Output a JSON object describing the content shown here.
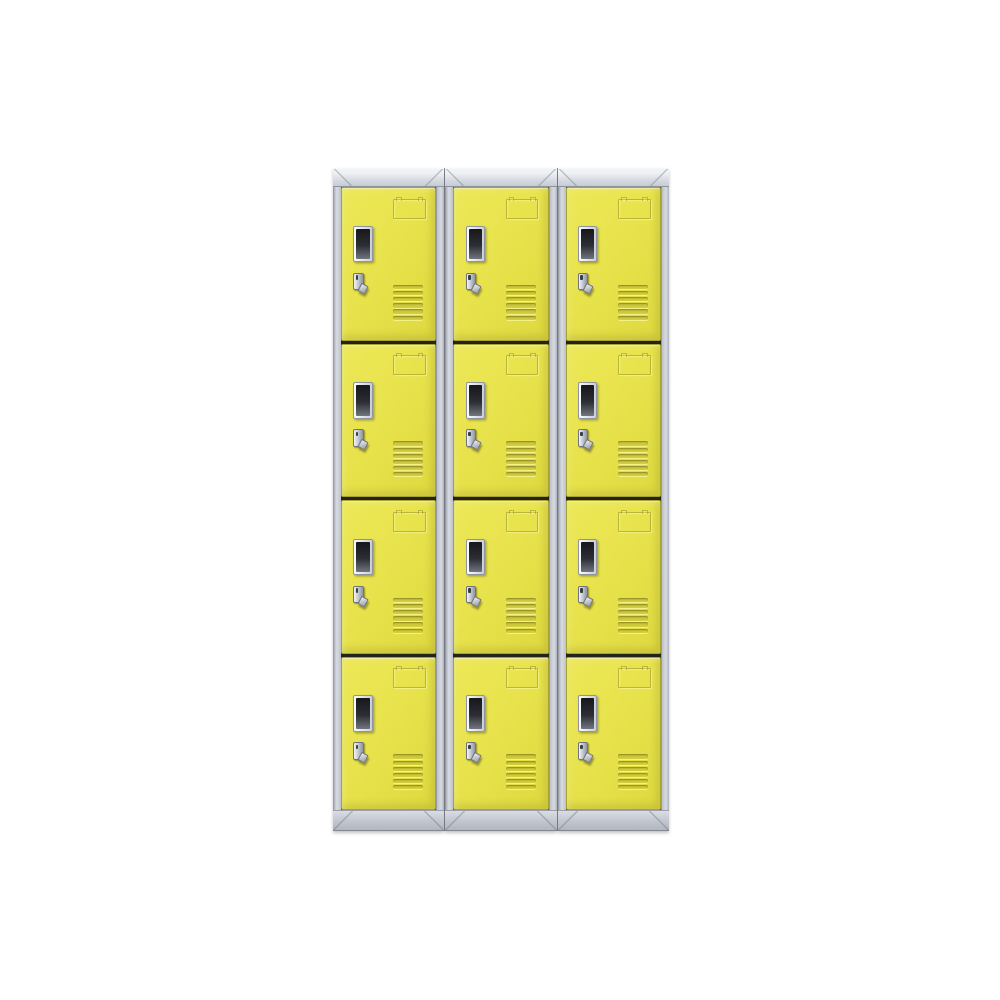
{
  "meta": {
    "type": "product-photo",
    "subject": "12-door storage locker cabinet set",
    "description": "Three side-by-side grey metal locker cabinets, each with four stacked yellow doors (12 doors total). Every door has an embossed label holder at the top, a dark name-card window with a silver frame on the left, a silver cam-latch handle below the window, and six embossed horizontal ventilation slats at the lower right. Plain white background, no text.",
    "visible_text": ""
  },
  "colors": {
    "background": "#ffffff",
    "door_yellow": "#e8e34c",
    "door_yellow_light": "#ece857",
    "door_yellow_dark": "#ded93f",
    "door_edge": "#a8a32e",
    "frame_gray": "#ccd0d8",
    "frame_gray_light": "#eef0f4",
    "frame_gray_dark": "#aeb2bc",
    "seam": "#8a8e98",
    "gap_dark": "#23231a",
    "window_dark": "#17171b",
    "silver": "#f2f4f7"
  },
  "locker": {
    "columns": 3,
    "rows": 4,
    "total_doors": 12,
    "door_features": {
      "label_holder": "embossed label holder",
      "window": "name card window",
      "handle": "cam latch handle",
      "vent_slat_count": 6
    }
  }
}
